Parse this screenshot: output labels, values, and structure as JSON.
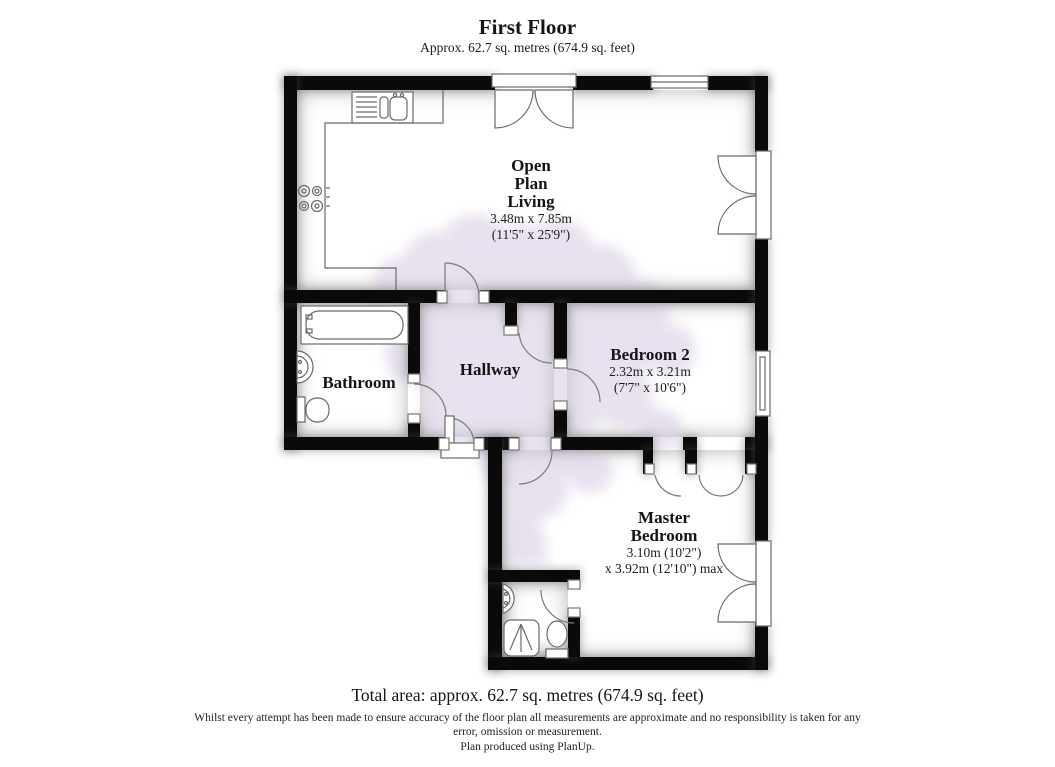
{
  "header": {
    "title": "First Floor",
    "subtitle": "Approx. 62.7 sq. metres (674.9 sq. feet)"
  },
  "rooms": {
    "living": {
      "line1": "Open",
      "line2": "Plan",
      "line3": "Living",
      "dims1": "3.48m x 7.85m",
      "dims2": "(11'5\" x 25'9\")"
    },
    "bathroom": {
      "name": "Bathroom"
    },
    "hallway": {
      "name": "Hallway"
    },
    "bedroom2": {
      "name": "Bedroom 2",
      "dims1": "2.32m x 3.21m",
      "dims2": "(7'7\" x 10'6\")"
    },
    "master": {
      "line1": "Master",
      "line2": "Bedroom",
      "dims1": "3.10m (10'2\")",
      "dims2": "x 3.92m (12'10\") max"
    }
  },
  "footer": {
    "total": "Total area: approx. 62.7 sq. metres (674.9 sq. feet)",
    "disclaimer": "Whilst every attempt has been made to ensure accuracy of the floor plan all measurements are approximate and no responsibility is taken for any error, omission or measurement.",
    "credit": "Plan produced using PlanUp."
  },
  "colors": {
    "wall": "#0a0a0a",
    "fixture_line": "#6a6a6a",
    "tree_watermark": "#d8cde2",
    "background": "#ffffff"
  }
}
